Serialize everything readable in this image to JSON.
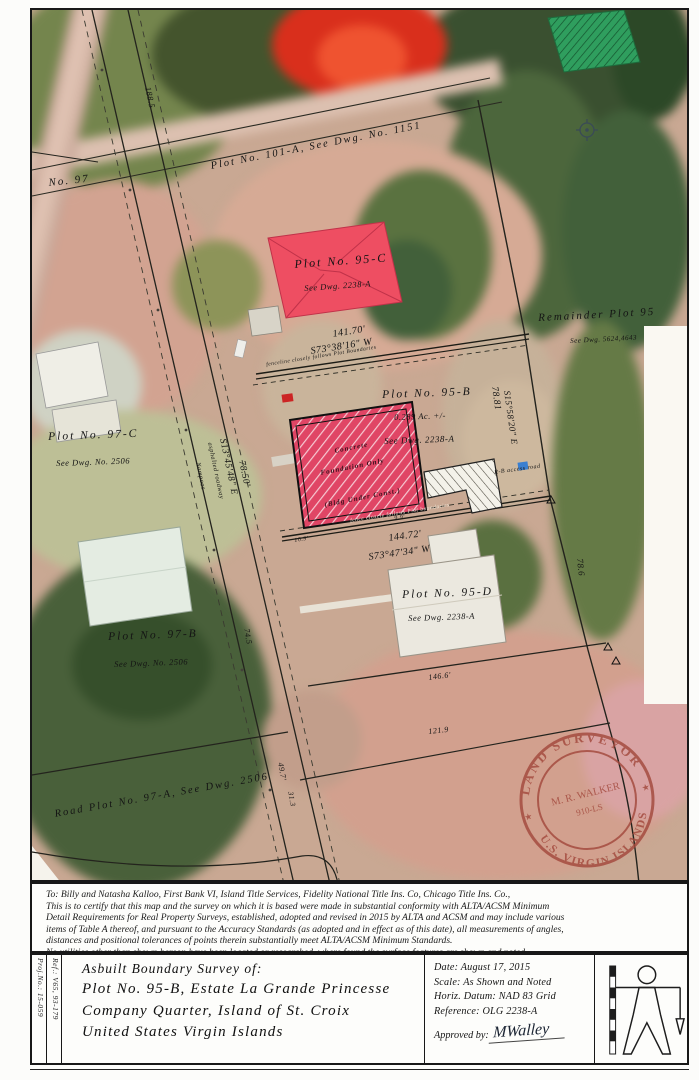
{
  "map": {
    "labels": [
      {
        "t": "No. 97",
        "x": 16,
        "y": 168,
        "r": -6,
        "s": 11,
        "c": "sp1"
      },
      {
        "t": "Plot No. 101-A, See Dwg. No. 1151",
        "x": 178,
        "y": 152,
        "r": -11,
        "s": 10.5,
        "c": "sp1"
      },
      {
        "t": "188.5",
        "x": 120,
        "y": 76,
        "r": 78,
        "s": 8.5
      },
      {
        "t": "Plot No. 95-C",
        "x": 262,
        "y": 248,
        "r": -4,
        "s": 12,
        "c": "sp1"
      },
      {
        "t": "See Dwg. 2238-A",
        "x": 272,
        "y": 274,
        "r": -4,
        "s": 8.5
      },
      {
        "t": "141.70'",
        "x": 300,
        "y": 320,
        "r": -9,
        "s": 10
      },
      {
        "t": "S73°38'16\" W",
        "x": 278,
        "y": 337,
        "r": -9,
        "s": 10
      },
      {
        "t": "fenceline closely follows Plot Boundaries",
        "x": 234,
        "y": 353,
        "r": -9,
        "s": 5.5
      },
      {
        "t": "Remainder Plot 95",
        "x": 506,
        "y": 303,
        "r": -3,
        "s": 11,
        "c": "sp1"
      },
      {
        "t": "See Dwg. 5624,4643",
        "x": 538,
        "y": 328,
        "r": -3,
        "s": 7
      },
      {
        "t": "Plot No. 95-B",
        "x": 350,
        "y": 380,
        "r": -2,
        "s": 11.5,
        "c": "sp1"
      },
      {
        "t": "0.289 Ac. +/-",
        "x": 362,
        "y": 403,
        "r": -2,
        "s": 8.5
      },
      {
        "t": "See Dwg. 2238-A",
        "x": 352,
        "y": 427,
        "r": -2,
        "s": 9
      },
      {
        "t": "78.81",
        "x": 466,
        "y": 376,
        "r": 82,
        "s": 9.5
      },
      {
        "t": "S15°58'20\" E",
        "x": 479,
        "y": 380,
        "r": 82,
        "s": 9
      },
      {
        "t": "Concrete",
        "x": 302,
        "y": 438,
        "r": -11,
        "s": 7,
        "c": "onred"
      },
      {
        "t": "Foundation Only",
        "x": 288,
        "y": 460,
        "r": -11,
        "s": 7,
        "c": "onred"
      },
      {
        "t": "(Bldg Under Const.)",
        "x": 292,
        "y": 492,
        "r": -11,
        "s": 7,
        "c": "onred"
      },
      {
        "t": "9.9'",
        "x": 362,
        "y": 506,
        "r": -9,
        "s": 6
      },
      {
        "t": "10.9'",
        "x": 262,
        "y": 528,
        "r": -9,
        "s": 6
      },
      {
        "t": "fence closely follows Plot boundaries",
        "x": 318,
        "y": 509,
        "r": -9,
        "s": 5.5,
        "c": "light"
      },
      {
        "t": "144.72'",
        "x": 356,
        "y": 524,
        "r": -8,
        "s": 10
      },
      {
        "t": "S73°47'34\" W",
        "x": 336,
        "y": 543,
        "r": -8,
        "s": 10
      },
      {
        "t": "R-B access road",
        "x": 462,
        "y": 460,
        "r": -8,
        "s": 6
      },
      {
        "t": "Plot No. 95-D",
        "x": 370,
        "y": 580,
        "r": -2,
        "s": 11.5,
        "c": "sp1"
      },
      {
        "t": "See Dwg. 2238-A",
        "x": 376,
        "y": 604,
        "r": -2,
        "s": 8.5
      },
      {
        "t": "78.6",
        "x": 552,
        "y": 548,
        "r": 84,
        "s": 9
      },
      {
        "t": "146.6'",
        "x": 396,
        "y": 664,
        "r": -7,
        "s": 8
      },
      {
        "t": "Plot No. 97-C",
        "x": 16,
        "y": 422,
        "r": -2,
        "s": 11.5,
        "c": "sp1"
      },
      {
        "t": "See Dwg. No. 2506",
        "x": 24,
        "y": 449,
        "r": -2,
        "s": 8.5
      },
      {
        "t": "Plot No. 97-B",
        "x": 76,
        "y": 622,
        "r": -2,
        "s": 11.5,
        "c": "sp1"
      },
      {
        "t": "See Dwg. No. 2506",
        "x": 82,
        "y": 650,
        "r": -2,
        "s": 8.5
      },
      {
        "t": "Nampoos",
        "x": 168,
        "y": 452,
        "r": 78,
        "s": 6.5
      },
      {
        "t": "asphalted roadway",
        "x": 180,
        "y": 432,
        "r": 78,
        "s": 6.5
      },
      {
        "t": "S13°45'48\" E",
        "x": 194,
        "y": 428,
        "r": 78,
        "s": 9.5
      },
      {
        "t": "78.50'",
        "x": 213,
        "y": 450,
        "r": 78,
        "s": 9.5
      },
      {
        "t": "74.5",
        "x": 218,
        "y": 618,
        "r": 80,
        "s": 8
      },
      {
        "t": "Road Plot No. 97-A, See Dwg. 2506",
        "x": 22,
        "y": 800,
        "r": -10,
        "s": 10.5,
        "c": "sp1"
      },
      {
        "t": "49.7'",
        "x": 252,
        "y": 752,
        "r": 80,
        "s": 8
      },
      {
        "t": "31.3",
        "x": 262,
        "y": 781,
        "r": 80,
        "s": 7.5
      },
      {
        "t": "121.9",
        "x": 396,
        "y": 718,
        "r": -6,
        "s": 8
      }
    ],
    "seal": {
      "top": "LAND SURVEYOR",
      "bottom": "U.S. VIRGIN ISLANDS",
      "name": "M. R. WALKER",
      "license": "910-LS"
    }
  },
  "certification": {
    "lines": [
      "To:  Billy and Natasha Kalloo, First Bank VI, Island Title Services, Fidelity National Title Ins. Co, Chicago Title Ins. Co.,",
      "This is to certify that this map and the survey on which it is based were made in substantial conformity with ALTA/ACSM Minimum",
      "Detail Requirements for Real Property Surveys, established, adopted and revised in 2015 by ALTA and ACSM and may include various",
      "items of Table A thereof, and pursuant to the Accuracy Standards (as adopted and in effect as of this date), all measurements of angles,",
      "distances and positional tolerances of points therein substantially meet ALTA/ACSM Minimum Standards.",
      "No utilities other than shown hereon have been located or researched, where found the surface features are shown and noted."
    ]
  },
  "title_block": {
    "proj_no": "Proj.No.: 15-059",
    "ref": "Ref.: V65, 93-179",
    "title_lines": [
      "Asbuilt Boundary Survey of:",
      "Plot No. 95-B, Estate La Grande Princesse",
      "Company Quarter, Island of St. Croix",
      "United States Virgin Islands"
    ],
    "fields": [
      "Date: August 17, 2015",
      "Scale: As Shown and Noted",
      "Horiz. Datum: NAD 83 Grid",
      "Reference: OLG 2238-A"
    ],
    "approved_label": "Approved by:",
    "signature": "MWalley"
  },
  "colors": {
    "seal_red": "#a3493d",
    "foundation_red": "#e04565",
    "roof_red": "#ee4e62",
    "roof_teal": "#2f9e5e"
  }
}
